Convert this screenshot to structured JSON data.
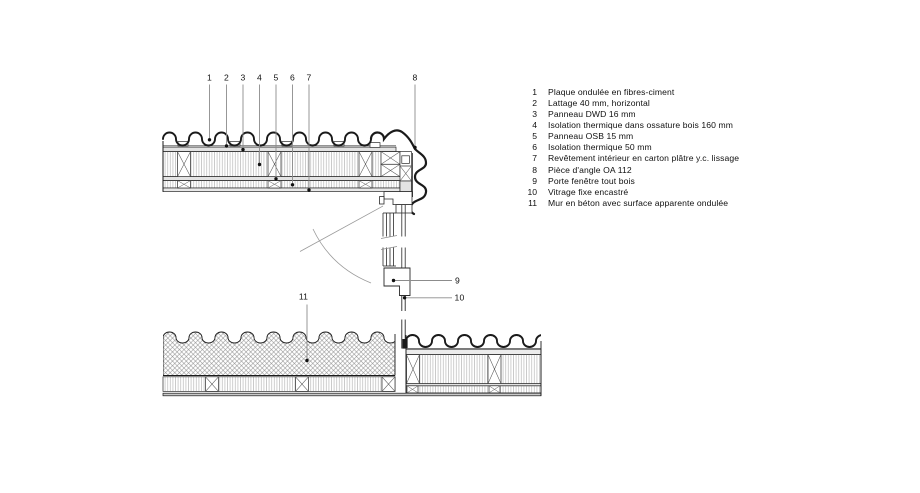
{
  "figure": {
    "type": "architectural section detail, roof-to-window corner junction",
    "language": "fr"
  },
  "callouts": {
    "n1": "1",
    "n2": "2",
    "n3": "3",
    "n4": "4",
    "n5": "5",
    "n6": "6",
    "n7": "7",
    "n8": "8",
    "n9": "9",
    "n10": "10",
    "n11": "11"
  },
  "legend": {
    "items": [
      {
        "num": "1",
        "text": "Plaque ondulée en fibres-ciment"
      },
      {
        "num": "2",
        "text": "Lattage 40 mm, horizontal"
      },
      {
        "num": "3",
        "text": "Panneau DWD 16 mm"
      },
      {
        "num": "4",
        "text": "Isolation thermique dans ossature bois 160 mm"
      },
      {
        "num": "5",
        "text": "Panneau OSB 15 mm"
      },
      {
        "num": "6",
        "text": "Isolation thermique 50 mm"
      },
      {
        "num": "7",
        "text": "Revêtement intérieur en carton plâtre y.c. lissage"
      },
      {
        "num": "8",
        "text": "Pièce d'angle OA 112"
      },
      {
        "num": "9",
        "text": "Porte fenêtre tout bois"
      },
      {
        "num": "10",
        "text": "Vitrage fixe encastré"
      },
      {
        "num": "11",
        "text": "Mur en béton avec surface apparente ondulée"
      }
    ]
  },
  "colors": {
    "line": "#1a1a1a",
    "leader": "#8c8c8c",
    "band_fill": "#e3e3e3",
    "hatch": "#bdbdbd",
    "crosshatch": "#8f8f8f"
  }
}
